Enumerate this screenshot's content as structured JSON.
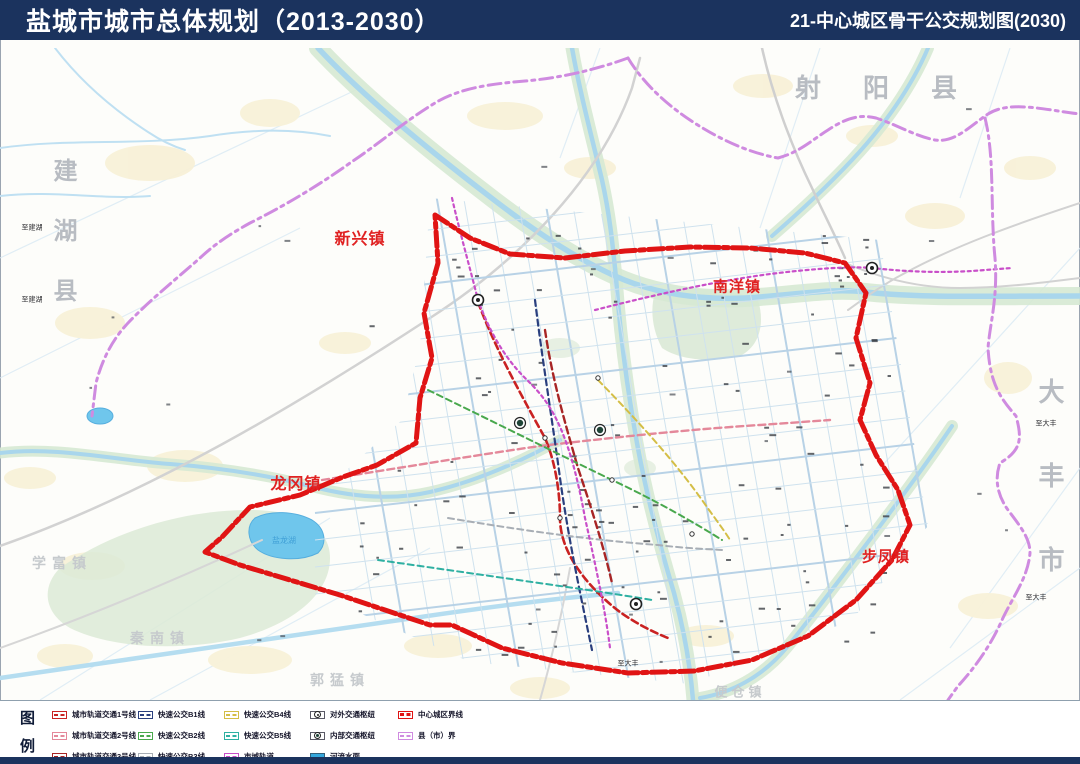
{
  "header": {
    "left_title": "盐城市城市总体规划（2013-2030）",
    "right_title": "21-中心城区骨干公交规划图(2030)"
  },
  "map": {
    "regions": [
      {
        "name": "射阳县"
      },
      {
        "name": "建湖县"
      },
      {
        "name": "大丰市"
      }
    ],
    "towns": [
      {
        "name": "新兴镇"
      },
      {
        "name": "南洋镇"
      },
      {
        "name": "龙冈镇"
      },
      {
        "name": "步凤镇"
      }
    ],
    "villages": [
      {
        "name": "学富镇"
      },
      {
        "name": "秦南镇"
      },
      {
        "name": "郭猛镇"
      },
      {
        "name": "便仓镇"
      }
    ],
    "water_label": "盐龙湖",
    "road_labels": [
      "至建湖",
      "至建湖",
      "至大丰",
      "至大丰",
      "至大丰"
    ]
  },
  "legend": {
    "title_top": "图",
    "title_bottom": "例",
    "items": [
      {
        "label": "城市轨道交通1号线",
        "kind": "line",
        "color": "#c92222"
      },
      {
        "label": "城市轨道交通2号线",
        "kind": "line",
        "color": "#e4889a"
      },
      {
        "label": "城市轨道交通3号线",
        "kind": "line",
        "color": "#a82525"
      },
      {
        "label": "快速公交B1线",
        "kind": "line",
        "color": "#2a3f7e"
      },
      {
        "label": "快速公交B2线",
        "kind": "line",
        "color": "#49a84d"
      },
      {
        "label": "快速公交B3线",
        "kind": "line",
        "color": "#a8aeb5"
      },
      {
        "label": "快速公交B4线",
        "kind": "line",
        "color": "#d4be46"
      },
      {
        "label": "快速公交B5线",
        "kind": "line",
        "color": "#2fb0a2"
      },
      {
        "label": "市域轨道",
        "kind": "line",
        "color": "#c94fc9"
      },
      {
        "label": "对外交通枢纽",
        "kind": "hub_ext",
        "color": "#222222"
      },
      {
        "label": "内部交通枢纽",
        "kind": "hub_int",
        "color": "#1f4437"
      },
      {
        "label": "河流水面",
        "kind": "water",
        "color": "#35a8dd"
      },
      {
        "label": "中心城区界线",
        "kind": "boundary",
        "color": "#e01414"
      },
      {
        "label": "县（市）界",
        "kind": "boundary",
        "color": "#cf8be0"
      }
    ]
  },
  "colors": {
    "header_bg": "#1b335e",
    "map_water": "#a9d6ec",
    "water_green": "#d6e9d3",
    "town_red": "#e02222",
    "region_gray": "#b8bcc2"
  }
}
